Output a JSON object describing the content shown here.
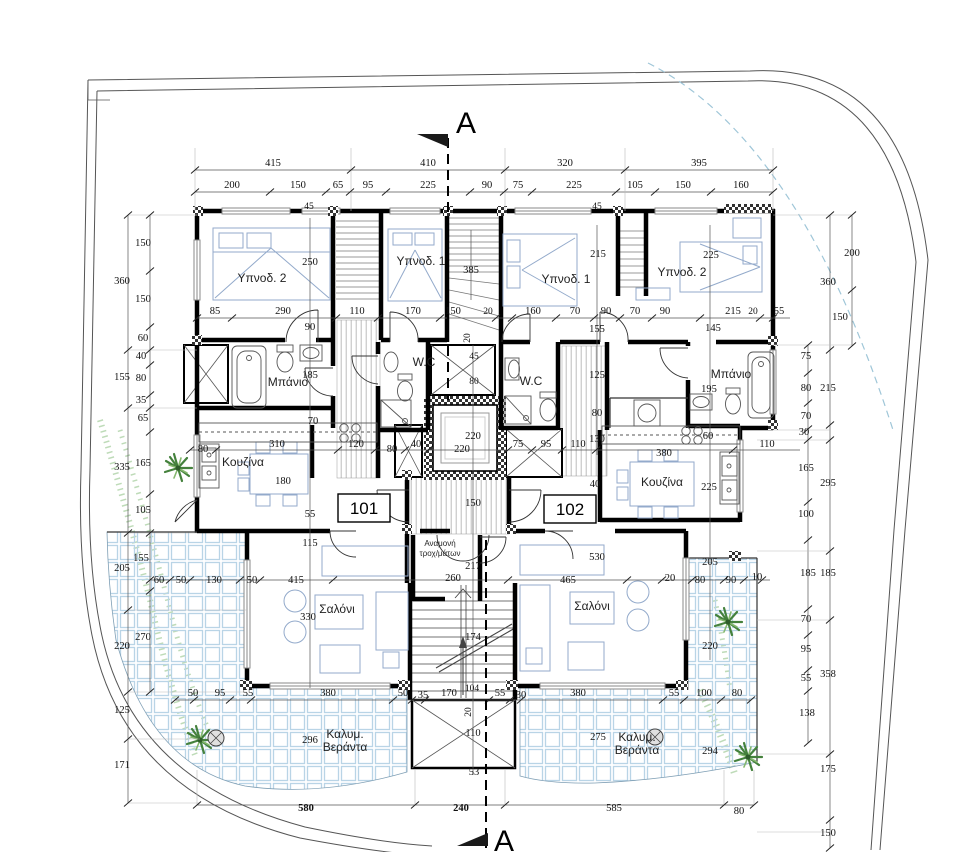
{
  "drawing": {
    "type": "architectural-floor-plan",
    "section_marker_top": "A",
    "section_marker_bottom": "A",
    "apartments": {
      "left": "101",
      "right": "102"
    },
    "rooms": {
      "bed2_left": "Υπνοδ. 2",
      "bed1_left": "Υπνοδ. 1",
      "bed1_right": "Υπνοδ. 1",
      "bed2_right": "Υπνοδ. 2",
      "bath_left": "Μπάνιο",
      "bath_right": "Μπάνιο",
      "wc_left": "W.C",
      "wc_right": "W.C",
      "kitchen_left": "Κουζίνα",
      "kitchen_right": "Κουζίνα",
      "living_left": "Σαλόνι",
      "living_right": "Σαλόνι",
      "veranda1": "Καλυμ.",
      "veranda2": "Βεράντα",
      "wheel1": "Αναμονή",
      "wheel2": "τροχ/μάτων"
    },
    "colors": {
      "wall": "#000000",
      "furniture": "#93aacb",
      "tile_grid": "#b9d4e6",
      "plant": "#44813c",
      "site_arc_dashed": "#9fc6d8"
    }
  },
  "dims": {
    "top1": [
      "415",
      "410",
      "320",
      "395"
    ],
    "top2": [
      "200",
      "150",
      "65",
      "95",
      "225",
      "90",
      "75",
      "225",
      "105",
      "150",
      "160"
    ],
    "top45": [
      "45",
      "45"
    ],
    "left_outer": [
      "360",
      "155",
      "335",
      "205",
      "220",
      "125",
      "171"
    ],
    "left_inner": [
      "150",
      "150",
      "60",
      "40",
      "80",
      "35",
      "65",
      "165",
      "105",
      "155",
      "270"
    ],
    "right_inner": [
      "75",
      "80",
      "70",
      "30",
      "165",
      "100",
      "185",
      "70",
      "95",
      "55",
      "138"
    ],
    "right_outer": [
      "360",
      "215",
      "295",
      "185",
      "358",
      "175",
      "150"
    ],
    "right_top": [
      "200",
      "150"
    ],
    "bottom": [
      "50",
      "95",
      "55",
      "380",
      "50",
      "35",
      "170",
      "55",
      "30",
      "380",
      "55",
      "100",
      "80"
    ],
    "totals": [
      "580",
      "240",
      "585",
      "80"
    ],
    "bedrow": [
      "85",
      "290",
      "110",
      "170",
      "150",
      "20",
      "160",
      "70",
      "90",
      "70",
      "90",
      "215",
      "20",
      "55"
    ],
    "bedrow2": [
      "90",
      "145",
      "155"
    ],
    "kitchrow": [
      "80",
      "310",
      "120",
      "80",
      "40",
      "75",
      "95",
      "110",
      "380",
      "110"
    ],
    "inner": [
      "250",
      "385",
      "215",
      "225",
      "185",
      "45",
      "80",
      "125",
      "195",
      "80",
      "130",
      "70",
      "220",
      "220",
      "60",
      "40",
      "150",
      "55",
      "115",
      "180",
      "217",
      "174",
      "110",
      "53",
      "104",
      "20",
      "20",
      "225",
      "60",
      "50",
      "130",
      "50",
      "415",
      "465",
      "260",
      "20",
      "80",
      "90",
      "10",
      "205",
      "530",
      "330",
      "220",
      "296",
      "275",
      "294"
    ]
  }
}
